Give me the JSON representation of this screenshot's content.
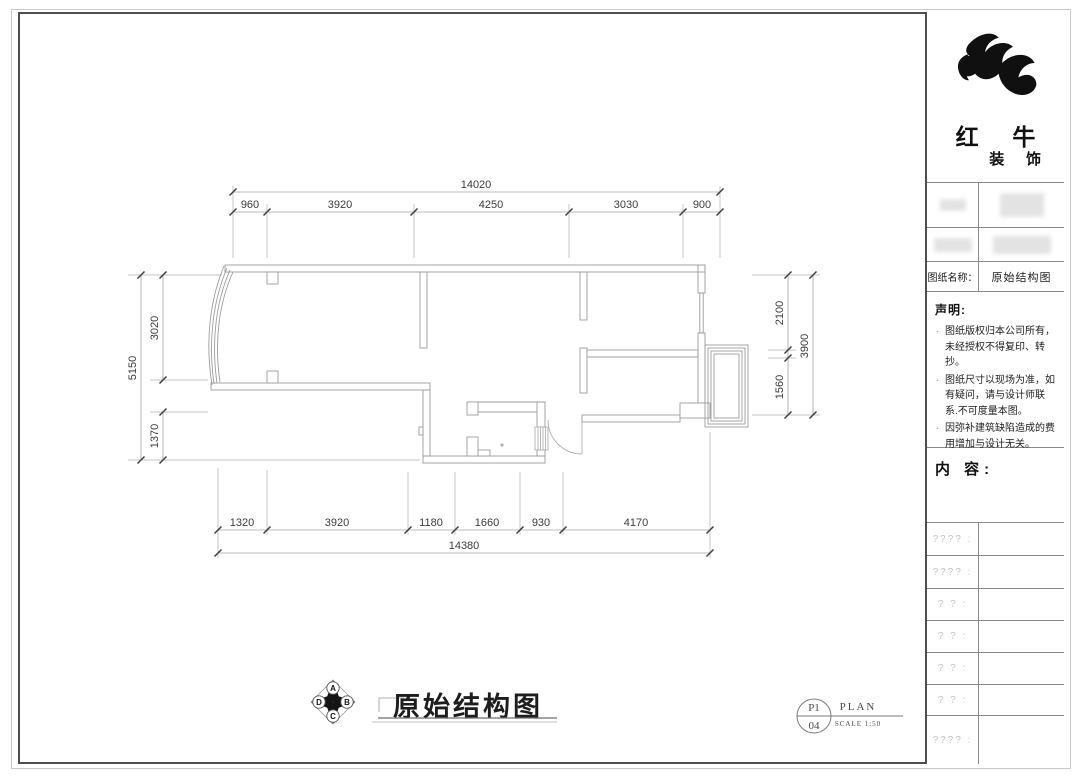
{
  "brand": {
    "name_top": "红 牛",
    "name_bottom": "装 饰"
  },
  "title_block": {
    "drawing_name_label": "图纸名称：",
    "drawing_name_value": "原始结构图"
  },
  "statement": {
    "title": "声明:",
    "items": [
      "图纸版权归本公司所有，未经授权不得复印、转抄。",
      "图纸尺寸以现场为准，如有疑问，请与设计师联系.不可度量本图。",
      "因弥补建筑缺陷造成的费用增加与设计无关。"
    ]
  },
  "content": {
    "label": "内 容:"
  },
  "placeholder_rows": [
    "???? :",
    "???? :",
    "? ? :",
    "? ? :",
    "? ? :",
    "? ? :",
    "???? :"
  ],
  "plan": {
    "title": "原始结构图",
    "compass": {
      "top": "A",
      "right": "B",
      "bottom": "C",
      "left": "D"
    },
    "sheet": {
      "number_top": "P1",
      "number_bottom": "04",
      "type": "PLAN",
      "scale": "SCALE 1:50"
    },
    "dims": {
      "top_total": "14020",
      "top_segments": [
        "960",
        "3920",
        "4250",
        "3030",
        "900"
      ],
      "left_total": "5150",
      "left_segments": [
        "3020",
        "1370"
      ],
      "right_total": "3900",
      "right_segments": [
        "2100",
        "1560"
      ],
      "bottom_total": "14380",
      "bottom_segments": [
        "1320",
        "3920",
        "1180",
        "1660",
        "930",
        "4170"
      ]
    },
    "colors": {
      "wall": "#9c9c9c",
      "dim_line": "#a4a4a4",
      "tick": "#3f3f3f",
      "text": "#3b3b3b"
    }
  }
}
